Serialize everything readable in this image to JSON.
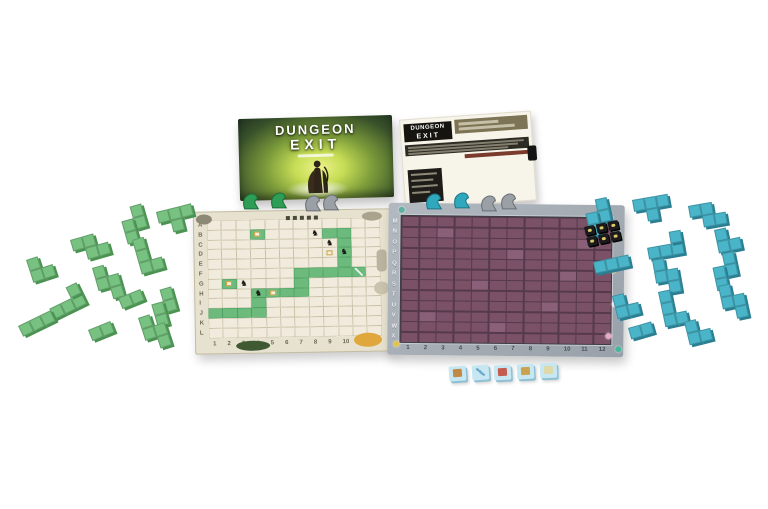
{
  "scene": {
    "background": "#ffffff",
    "description": "Dungeon Exit board game components product photo"
  },
  "colors": {
    "green_piece": "#77c181",
    "green_piece_edge": "#49924f",
    "blue_piece": "#4ab4c8",
    "blue_piece_edge": "#2a7e92",
    "parchment": "#e7e2cf",
    "parchment_cell": "#f0ebdc",
    "parchment_line": "#c8c0a6",
    "path_green": "#6cbb7d",
    "path_green_edge": "#4d9c61",
    "stone_border": "#a8afb7",
    "purple_cell": "#7a5166",
    "purple_gap": "#563a4b",
    "item_tile": "#c7e7f2",
    "item_tile_edge": "#8fc0d4",
    "monster_tile": "#1b1b1d",
    "monster_tile_icon": "#d9c967"
  },
  "glyphs": {
    "monster": "♞"
  },
  "box": {
    "logo_line1": "DUNGEON",
    "logo_line2": "EXIT"
  },
  "sheet": {
    "logo_line1": "DUNGEON",
    "logo_line2": "EXIT"
  },
  "left_board": {
    "rows": 12,
    "cols": 12,
    "row_labels": [
      "A",
      "B",
      "C",
      "D",
      "E",
      "F",
      "G",
      "H",
      "I",
      "J",
      "K",
      "L"
    ],
    "col_labels": [
      "1",
      "2",
      "3",
      "4",
      "5",
      "6",
      "7",
      "8",
      "9",
      "10",
      "11",
      "12"
    ],
    "green_cells": [
      [
        4,
        2
      ],
      [
        9,
        2
      ],
      [
        10,
        2
      ],
      [
        10,
        3
      ],
      [
        10,
        4
      ],
      [
        10,
        5
      ],
      [
        10,
        6
      ],
      [
        9,
        6
      ],
      [
        8,
        6
      ],
      [
        7,
        6
      ],
      [
        7,
        7
      ],
      [
        7,
        8
      ],
      [
        6,
        8
      ],
      [
        5,
        8
      ],
      [
        4,
        8
      ],
      [
        4,
        9
      ],
      [
        4,
        10
      ],
      [
        3,
        10
      ],
      [
        2,
        10
      ],
      [
        1,
        10
      ],
      [
        2,
        7
      ],
      [
        11,
        6
      ]
    ],
    "monster_cells": [
      [
        8,
        2
      ],
      [
        9,
        3
      ],
      [
        10,
        4
      ],
      [
        3,
        7
      ],
      [
        4,
        8
      ]
    ],
    "item_cells": [
      [
        4,
        2
      ],
      [
        9,
        4
      ],
      [
        5,
        8
      ],
      [
        2,
        7
      ]
    ],
    "sword_cells": [
      [
        11,
        6
      ]
    ],
    "decorations": [
      {
        "x": 92,
        "y": 5,
        "w": 4,
        "h": 4,
        "color": "#4a4a3a",
        "r": "0"
      },
      {
        "x": 99,
        "y": 5,
        "w": 4,
        "h": 4,
        "color": "#4a4a3a",
        "r": "0"
      },
      {
        "x": 106,
        "y": 5,
        "w": 4,
        "h": 4,
        "color": "#4a4a3a",
        "r": "0"
      },
      {
        "x": 113,
        "y": 5,
        "w": 4,
        "h": 4,
        "color": "#4a4a3a",
        "r": "0"
      },
      {
        "x": 120,
        "y": 5,
        "w": 4,
        "h": 4,
        "color": "#4a4a3a",
        "r": "0"
      },
      {
        "x": 40,
        "y": 129,
        "w": 34,
        "h": 10,
        "color": "#3f5a33",
        "r": "50%"
      },
      {
        "x": 158,
        "y": 123,
        "w": 28,
        "h": 14,
        "color": "#e0a83c",
        "r": "50%"
      },
      {
        "x": 182,
        "y": 40,
        "w": 10,
        "h": 22,
        "color": "#b9b3a0",
        "r": "4px"
      },
      {
        "x": 179,
        "y": 72,
        "w": 15,
        "h": 13,
        "color": "#c9c3ae",
        "r": "50%"
      },
      {
        "x": 2,
        "y": 2,
        "w": 16,
        "h": 10,
        "color": "#8e8876",
        "r": "50%"
      },
      {
        "x": 168,
        "y": 2,
        "w": 20,
        "h": 9,
        "color": "#a9a28c",
        "r": "50%"
      }
    ]
  },
  "right_board": {
    "rows": 12,
    "cols": 12,
    "row_labels": [
      "M",
      "N",
      "O",
      "P",
      "Q",
      "R",
      "S",
      "T",
      "U",
      "V",
      "W",
      "X"
    ],
    "col_labels": [
      "1",
      "2",
      "3",
      "4",
      "5",
      "6",
      "7",
      "8",
      "9",
      "10",
      "11",
      "12"
    ],
    "light_cells": [
      [
        3,
        2
      ],
      [
        7,
        4
      ],
      [
        5,
        7
      ],
      [
        9,
        9
      ],
      [
        2,
        10
      ],
      [
        10,
        6
      ],
      [
        6,
        11
      ],
      [
        11,
        3
      ]
    ],
    "border_icons": [
      {
        "x": 212,
        "y": 4,
        "color": "#e8a8c8"
      },
      {
        "x": 222,
        "y": 62,
        "color": "#e3c34f"
      },
      {
        "x": 224,
        "y": 96,
        "color": "#f0e6ee"
      },
      {
        "x": 218,
        "y": 128,
        "color": "#e8a8c8"
      },
      {
        "x": 6,
        "y": 138,
        "color": "#e3c34f"
      },
      {
        "x": 228,
        "y": 141,
        "color": "#46b89a"
      },
      {
        "x": 10,
        "y": 4,
        "color": "#5bb0a0"
      }
    ]
  },
  "piece_shapes": {
    "i2": [
      [
        0,
        0
      ],
      [
        1,
        0
      ]
    ],
    "i3": [
      [
        0,
        0
      ],
      [
        1,
        0
      ],
      [
        2,
        0
      ]
    ],
    "l3": [
      [
        0,
        0
      ],
      [
        0,
        1
      ],
      [
        1,
        1
      ]
    ],
    "s": [
      [
        1,
        0
      ],
      [
        2,
        0
      ],
      [
        0,
        1
      ],
      [
        1,
        1
      ]
    ],
    "z": [
      [
        0,
        0
      ],
      [
        1,
        0
      ],
      [
        1,
        1
      ],
      [
        2,
        1
      ]
    ],
    "t": [
      [
        0,
        0
      ],
      [
        1,
        0
      ],
      [
        2,
        0
      ],
      [
        1,
        1
      ]
    ],
    "l4": [
      [
        0,
        0
      ],
      [
        0,
        1
      ],
      [
        0,
        2
      ],
      [
        1,
        2
      ]
    ],
    "l4f": [
      [
        0,
        1
      ],
      [
        1,
        1
      ],
      [
        2,
        1
      ],
      [
        2,
        0
      ]
    ],
    "sv": [
      [
        1,
        0
      ],
      [
        1,
        1
      ],
      [
        0,
        1
      ],
      [
        0,
        2
      ]
    ],
    "zv": [
      [
        0,
        0
      ],
      [
        0,
        1
      ],
      [
        1,
        1
      ],
      [
        1,
        2
      ]
    ]
  },
  "green_pieces": {
    "name": "green",
    "color": "#77c181",
    "edge": "#49924f",
    "pieces": [
      [
        118,
        210,
        -16,
        "sv"
      ],
      [
        156,
        212,
        -14,
        "t"
      ],
      [
        70,
        240,
        -16,
        "z"
      ],
      [
        132,
        240,
        -16,
        "l4"
      ],
      [
        26,
        260,
        -18,
        "l3"
      ],
      [
        92,
        268,
        -16,
        "zv"
      ],
      [
        118,
        298,
        -22,
        "i2"
      ],
      [
        148,
        293,
        -16,
        "sv"
      ],
      [
        44,
        298,
        -26,
        "l4f"
      ],
      [
        18,
        326,
        -26,
        "i3"
      ],
      [
        88,
        330,
        -22,
        "i2"
      ],
      [
        138,
        318,
        -18,
        "zv"
      ]
    ]
  },
  "blue_pieces": {
    "name": "blue",
    "color": "#4ab4c8",
    "edge": "#2a7e92",
    "pieces": [
      [
        583,
        202,
        -12,
        "sv"
      ],
      [
        632,
        200,
        -10,
        "t"
      ],
      [
        688,
        206,
        -10,
        "z"
      ],
      [
        645,
        236,
        -10,
        "l4f"
      ],
      [
        714,
        230,
        -12,
        "l3"
      ],
      [
        593,
        262,
        -12,
        "i3"
      ],
      [
        652,
        260,
        -10,
        "zv"
      ],
      [
        710,
        256,
        -12,
        "sv"
      ],
      [
        612,
        296,
        -14,
        "l3"
      ],
      [
        658,
        292,
        -12,
        "l4"
      ],
      [
        718,
        286,
        -12,
        "zv"
      ],
      [
        628,
        328,
        -16,
        "i2"
      ],
      [
        684,
        322,
        -14,
        "l3"
      ]
    ]
  },
  "monster_tiles": {
    "rows": 2,
    "cols": 3,
    "x": 584,
    "y": 227,
    "rot": -12
  },
  "item_tiles": {
    "tiles": [
      [
        449,
        366,
        -4,
        "chest"
      ],
      [
        472,
        365,
        -4,
        "sword"
      ],
      [
        494,
        365,
        -3,
        "potion"
      ],
      [
        517,
        364,
        -3,
        "compass"
      ],
      [
        540,
        363,
        -2,
        "map"
      ]
    ],
    "icon_colors": {
      "chest": "#c08a45",
      "sword": "#6fa8c9",
      "potion": "#c45b4e",
      "compass": "#caa24f",
      "map": "#ded9a8"
    }
  },
  "meeples": {
    "types": {
      "green": {
        "fill": "#2e9e57",
        "stroke": "#1c6e3a"
      },
      "teal": {
        "fill": "#2fa8bd",
        "stroke": "#1d7486"
      },
      "gray": {
        "fill": "#9aa0a6",
        "stroke": "#6b7075"
      }
    },
    "list": [
      {
        "x": 241,
        "y": 191,
        "type": "green"
      },
      {
        "x": 269,
        "y": 190,
        "type": "green"
      },
      {
        "x": 303,
        "y": 193,
        "type": "gray"
      },
      {
        "x": 321,
        "y": 192,
        "type": "gray"
      },
      {
        "x": 424,
        "y": 191,
        "type": "teal"
      },
      {
        "x": 452,
        "y": 190,
        "type": "teal"
      },
      {
        "x": 479,
        "y": 193,
        "type": "gray"
      },
      {
        "x": 499,
        "y": 191,
        "type": "gray"
      }
    ]
  }
}
